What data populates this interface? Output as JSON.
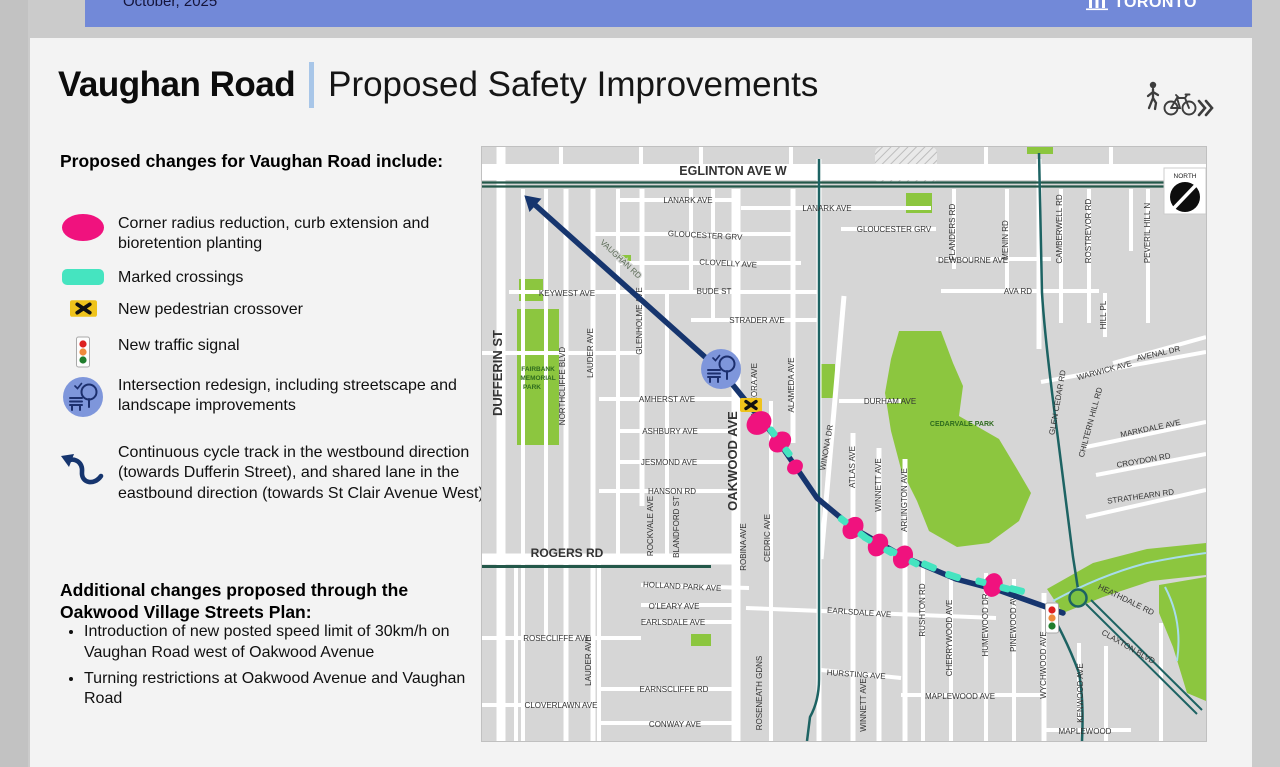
{
  "topbar": {
    "date": "October, 2025",
    "logo_text": "TORONTO"
  },
  "header": {
    "title": "Vaughan Road",
    "subtitle": "Proposed Safety Improvements"
  },
  "legend": {
    "heading": "Proposed changes for Vaughan Road include:",
    "items": [
      {
        "icon": "curb-extension-icon",
        "label": "Corner radius reduction, curb extension and bioretention planting"
      },
      {
        "icon": "marked-crossing-icon",
        "label": "Marked crossings"
      },
      {
        "icon": "pedestrian-crossover-icon",
        "label": "New pedestrian crossover"
      },
      {
        "icon": "traffic-signal-icon",
        "label": "New traffic signal"
      },
      {
        "icon": "intersection-redesign-icon",
        "label": "Intersection redesign, including streetscape and landscape improvements"
      },
      {
        "icon": "cycle-track-arrow-icon",
        "label": "Continuous cycle track in the westbound direction (towards Dufferin Street), and shared lane in the eastbound direction (towards St Clair Avenue West)"
      }
    ]
  },
  "additional": {
    "heading": "Additional changes proposed through the Oakwood Village Streets Plan:",
    "bullets": [
      "Introduction of new posted speed limit of 30km/h on Vaughan Road west of Oakwood Avenue",
      "Turning restrictions at Oakwood Avenue and Vaughan Road"
    ]
  },
  "colors": {
    "pink": "#F0127E",
    "teal": "#45E4C0",
    "yellow": "#EFC31B",
    "navy": "#16356E",
    "icon_blue": "#7E96DB",
    "park_green": "#8CC63F",
    "route_teal": "#1D6363",
    "road_green": "#24584A"
  },
  "map": {
    "compass_label": "NORTH",
    "route": {
      "color": "#16356E",
      "points": [
        [
          533,
          203
        ],
        [
          723,
          373
        ],
        [
          775,
          437
        ],
        [
          816,
          497
        ],
        [
          852,
          527
        ],
        [
          903,
          556
        ],
        [
          955,
          578
        ],
        [
          1000,
          590
        ],
        [
          1062,
          612
        ]
      ]
    },
    "markers": [
      {
        "type": "intersection",
        "x": 720,
        "y": 368
      },
      {
        "type": "pedestrian-crossover",
        "x": 750,
        "y": 404
      },
      {
        "type": "curb-extension",
        "x": 758,
        "y": 422,
        "a": 52,
        "s": 1.1
      },
      {
        "type": "curb-extension-crossing",
        "x": 779,
        "y": 441,
        "a": 53
      },
      {
        "type": "curb-extension",
        "x": 794,
        "y": 466,
        "a": 54,
        "s": 0.7
      },
      {
        "type": "curb-extension-crossing",
        "x": 852,
        "y": 527,
        "a": 38
      },
      {
        "type": "curb-extension-crossing",
        "x": 877,
        "y": 544,
        "a": 30
      },
      {
        "type": "curb-extension-crossing",
        "x": 902,
        "y": 556,
        "a": 27
      },
      {
        "type": "crossing",
        "x": 928,
        "y": 565,
        "a": 23
      },
      {
        "type": "crossing",
        "x": 952,
        "y": 575,
        "a": 18
      },
      {
        "type": "curb-extension-crossing",
        "x": 992,
        "y": 584,
        "a": 15
      },
      {
        "type": "crossing",
        "x": 1016,
        "y": 589,
        "a": 15
      },
      {
        "type": "traffic-signal",
        "x": 1051,
        "y": 617
      },
      {
        "type": "roundabout",
        "x": 1077,
        "y": 597
      }
    ],
    "labels": [
      {
        "t": "EGLINTON AVE W",
        "x": 732,
        "y": 174,
        "s": 12.5,
        "b": 1
      },
      {
        "t": "LANARK AVE",
        "x": 687,
        "y": 202
      },
      {
        "t": "LANARK AVE",
        "x": 826,
        "y": 210
      },
      {
        "t": "GLOUCESTER GRV",
        "x": 704,
        "y": 237,
        "r": 3
      },
      {
        "t": "GLOUCESTER GRV",
        "x": 893,
        "y": 231
      },
      {
        "t": "CLOVELLY AVE",
        "x": 727,
        "y": 265,
        "r": 3
      },
      {
        "t": "BUDE ST",
        "x": 713,
        "y": 293
      },
      {
        "t": "STRADER AVE",
        "x": 756,
        "y": 322
      },
      {
        "t": "KEYWEST AVE",
        "x": 566,
        "y": 295
      },
      {
        "t": "DEWBOURNE AVE",
        "x": 972,
        "y": 262
      },
      {
        "t": "AVA RD",
        "x": 1017,
        "y": 293
      },
      {
        "t": "AMHERST AVE",
        "x": 666,
        "y": 401
      },
      {
        "t": "ASHBURY AVE",
        "x": 669,
        "y": 433
      },
      {
        "t": "JESMOND AVE",
        "x": 668,
        "y": 464
      },
      {
        "t": "HANSON RD",
        "x": 671,
        "y": 493
      },
      {
        "t": "DURHAM AVE",
        "x": 889,
        "y": 403
      },
      {
        "t": "CEDARVALE PARK",
        "x": 961,
        "y": 425,
        "s": 7,
        "b": 1,
        "c": "#2e6b1e"
      },
      {
        "t": "ROGERS RD",
        "x": 566,
        "y": 556,
        "s": 12,
        "b": 1
      },
      {
        "t": "HOLLAND PARK AVE",
        "x": 681,
        "y": 588,
        "r": 3
      },
      {
        "t": "O'LEARY AVE",
        "x": 673,
        "y": 608
      },
      {
        "t": "EARLSDALE AVE",
        "x": 672,
        "y": 624
      },
      {
        "t": "EARLSDALE AVE",
        "x": 858,
        "y": 614,
        "r": 4
      },
      {
        "t": "ROSECLIFFE AVE",
        "x": 556,
        "y": 640
      },
      {
        "t": "HURSTING AVE",
        "x": 855,
        "y": 676,
        "r": 4
      },
      {
        "t": "EARNSCLIFFE RD",
        "x": 673,
        "y": 691
      },
      {
        "t": "CLOVERLAWN AVE",
        "x": 560,
        "y": 707
      },
      {
        "t": "CONWAY AVE",
        "x": 674,
        "y": 726
      },
      {
        "t": "MAPLEWOOD AVE",
        "x": 959,
        "y": 698
      },
      {
        "t": "MAPLEWOOD",
        "x": 1084,
        "y": 733
      },
      {
        "t": "AVENAL DR",
        "x": 1158,
        "y": 355,
        "r": -13
      },
      {
        "t": "WARWICK AVE",
        "x": 1104,
        "y": 372,
        "r": -15
      },
      {
        "t": "MARKDALE AVE",
        "x": 1150,
        "y": 430,
        "r": -12
      },
      {
        "t": "CROYDON RD",
        "x": 1143,
        "y": 462,
        "r": -10
      },
      {
        "t": "STRATHEARN RD",
        "x": 1140,
        "y": 498,
        "r": -8
      },
      {
        "t": "HEATHDALE RD",
        "x": 1124,
        "y": 601,
        "r": 26
      },
      {
        "t": "CLAXTON BLVD",
        "x": 1126,
        "y": 648,
        "r": 30
      },
      {
        "t": "VAUGHAN RD",
        "x": 618,
        "y": 260,
        "r": 43,
        "c": "#5a6a55",
        "h": 1
      },
      {
        "t": "DUFFERIN ST",
        "x": 501,
        "y": 372,
        "s": 13,
        "b": 1,
        "r": -90
      },
      {
        "t": "NORTHCLIFFE BLVD",
        "x": 564,
        "y": 385,
        "r": -90
      },
      {
        "t": "LAUDER AVE",
        "x": 592,
        "y": 352,
        "r": -90
      },
      {
        "t": "GLENHOLME AVE",
        "x": 641,
        "y": 320,
        "r": -90
      },
      {
        "t": "LAUDER AVE",
        "x": 590,
        "y": 660,
        "r": -90
      },
      {
        "t": "OAKWOOD AVE",
        "x": 736,
        "y": 460,
        "s": 13,
        "b": 1,
        "r": -90
      },
      {
        "t": "GLENORA AVE",
        "x": 756,
        "y": 390,
        "r": -90
      },
      {
        "t": "ALAMEDA AVE",
        "x": 793,
        "y": 384,
        "r": -90
      },
      {
        "t": "WINONA DR",
        "x": 828,
        "y": 447,
        "r": -80
      },
      {
        "t": "ATLAS AVE",
        "x": 854,
        "y": 466,
        "r": -90
      },
      {
        "t": "WINNETT AVE",
        "x": 880,
        "y": 484,
        "r": -90
      },
      {
        "t": "ARLINGTON AVE",
        "x": 906,
        "y": 499,
        "r": -90
      },
      {
        "t": "ROCKVALE AVE",
        "x": 652,
        "y": 525,
        "r": -90
      },
      {
        "t": "BLANDFORD ST",
        "x": 678,
        "y": 526,
        "r": -90
      },
      {
        "t": "ROBINA AVE",
        "x": 745,
        "y": 546,
        "r": -90
      },
      {
        "t": "CEDRIC AVE",
        "x": 769,
        "y": 537,
        "r": -90
      },
      {
        "t": "ROSENEATH GDNS",
        "x": 761,
        "y": 692,
        "r": -90
      },
      {
        "t": "RUSHTON RD",
        "x": 924,
        "y": 609,
        "r": -90
      },
      {
        "t": "CHERRYWOOD AVE",
        "x": 951,
        "y": 637,
        "r": -90
      },
      {
        "t": "HUMEWOOD DR",
        "x": 987,
        "y": 624,
        "r": -90
      },
      {
        "t": "PINEWOOD AVE",
        "x": 1015,
        "y": 620,
        "r": -90
      },
      {
        "t": "WYCHWOOD AVE",
        "x": 1045,
        "y": 664,
        "r": -90
      },
      {
        "t": "KENWOOD AVE",
        "x": 1082,
        "y": 692,
        "r": -90
      },
      {
        "t": "WINNETT AVE",
        "x": 865,
        "y": 704,
        "r": -90
      },
      {
        "t": "FLANDERS RD",
        "x": 954,
        "y": 231,
        "r": -90
      },
      {
        "t": "MENIN RD",
        "x": 1007,
        "y": 239,
        "r": -90
      },
      {
        "t": "CAMBERWELL RD",
        "x": 1061,
        "y": 228,
        "r": -90
      },
      {
        "t": "ROSTREVOR RD",
        "x": 1090,
        "y": 230,
        "r": -90
      },
      {
        "t": "PEVERIL HILL N",
        "x": 1149,
        "y": 232,
        "r": -90
      },
      {
        "t": "HILL PL",
        "x": 1105,
        "y": 314,
        "r": -90
      },
      {
        "t": "GLEN CEDAR RD",
        "x": 1059,
        "y": 402,
        "r": -80
      },
      {
        "t": "CHILTERN HILL RD",
        "x": 1092,
        "y": 422,
        "r": -75
      },
      {
        "t": "FAIRBANK",
        "x": 537,
        "y": 370,
        "s": 6.5,
        "b": 1,
        "c": "#2e6b1e"
      },
      {
        "t": "MEMORIAL",
        "x": 537,
        "y": 379,
        "s": 6.5,
        "b": 1,
        "c": "#2e6b1e"
      },
      {
        "t": "PARK",
        "x": 531,
        "y": 388,
        "s": 6.5,
        "b": 1,
        "c": "#2e6b1e"
      }
    ]
  }
}
